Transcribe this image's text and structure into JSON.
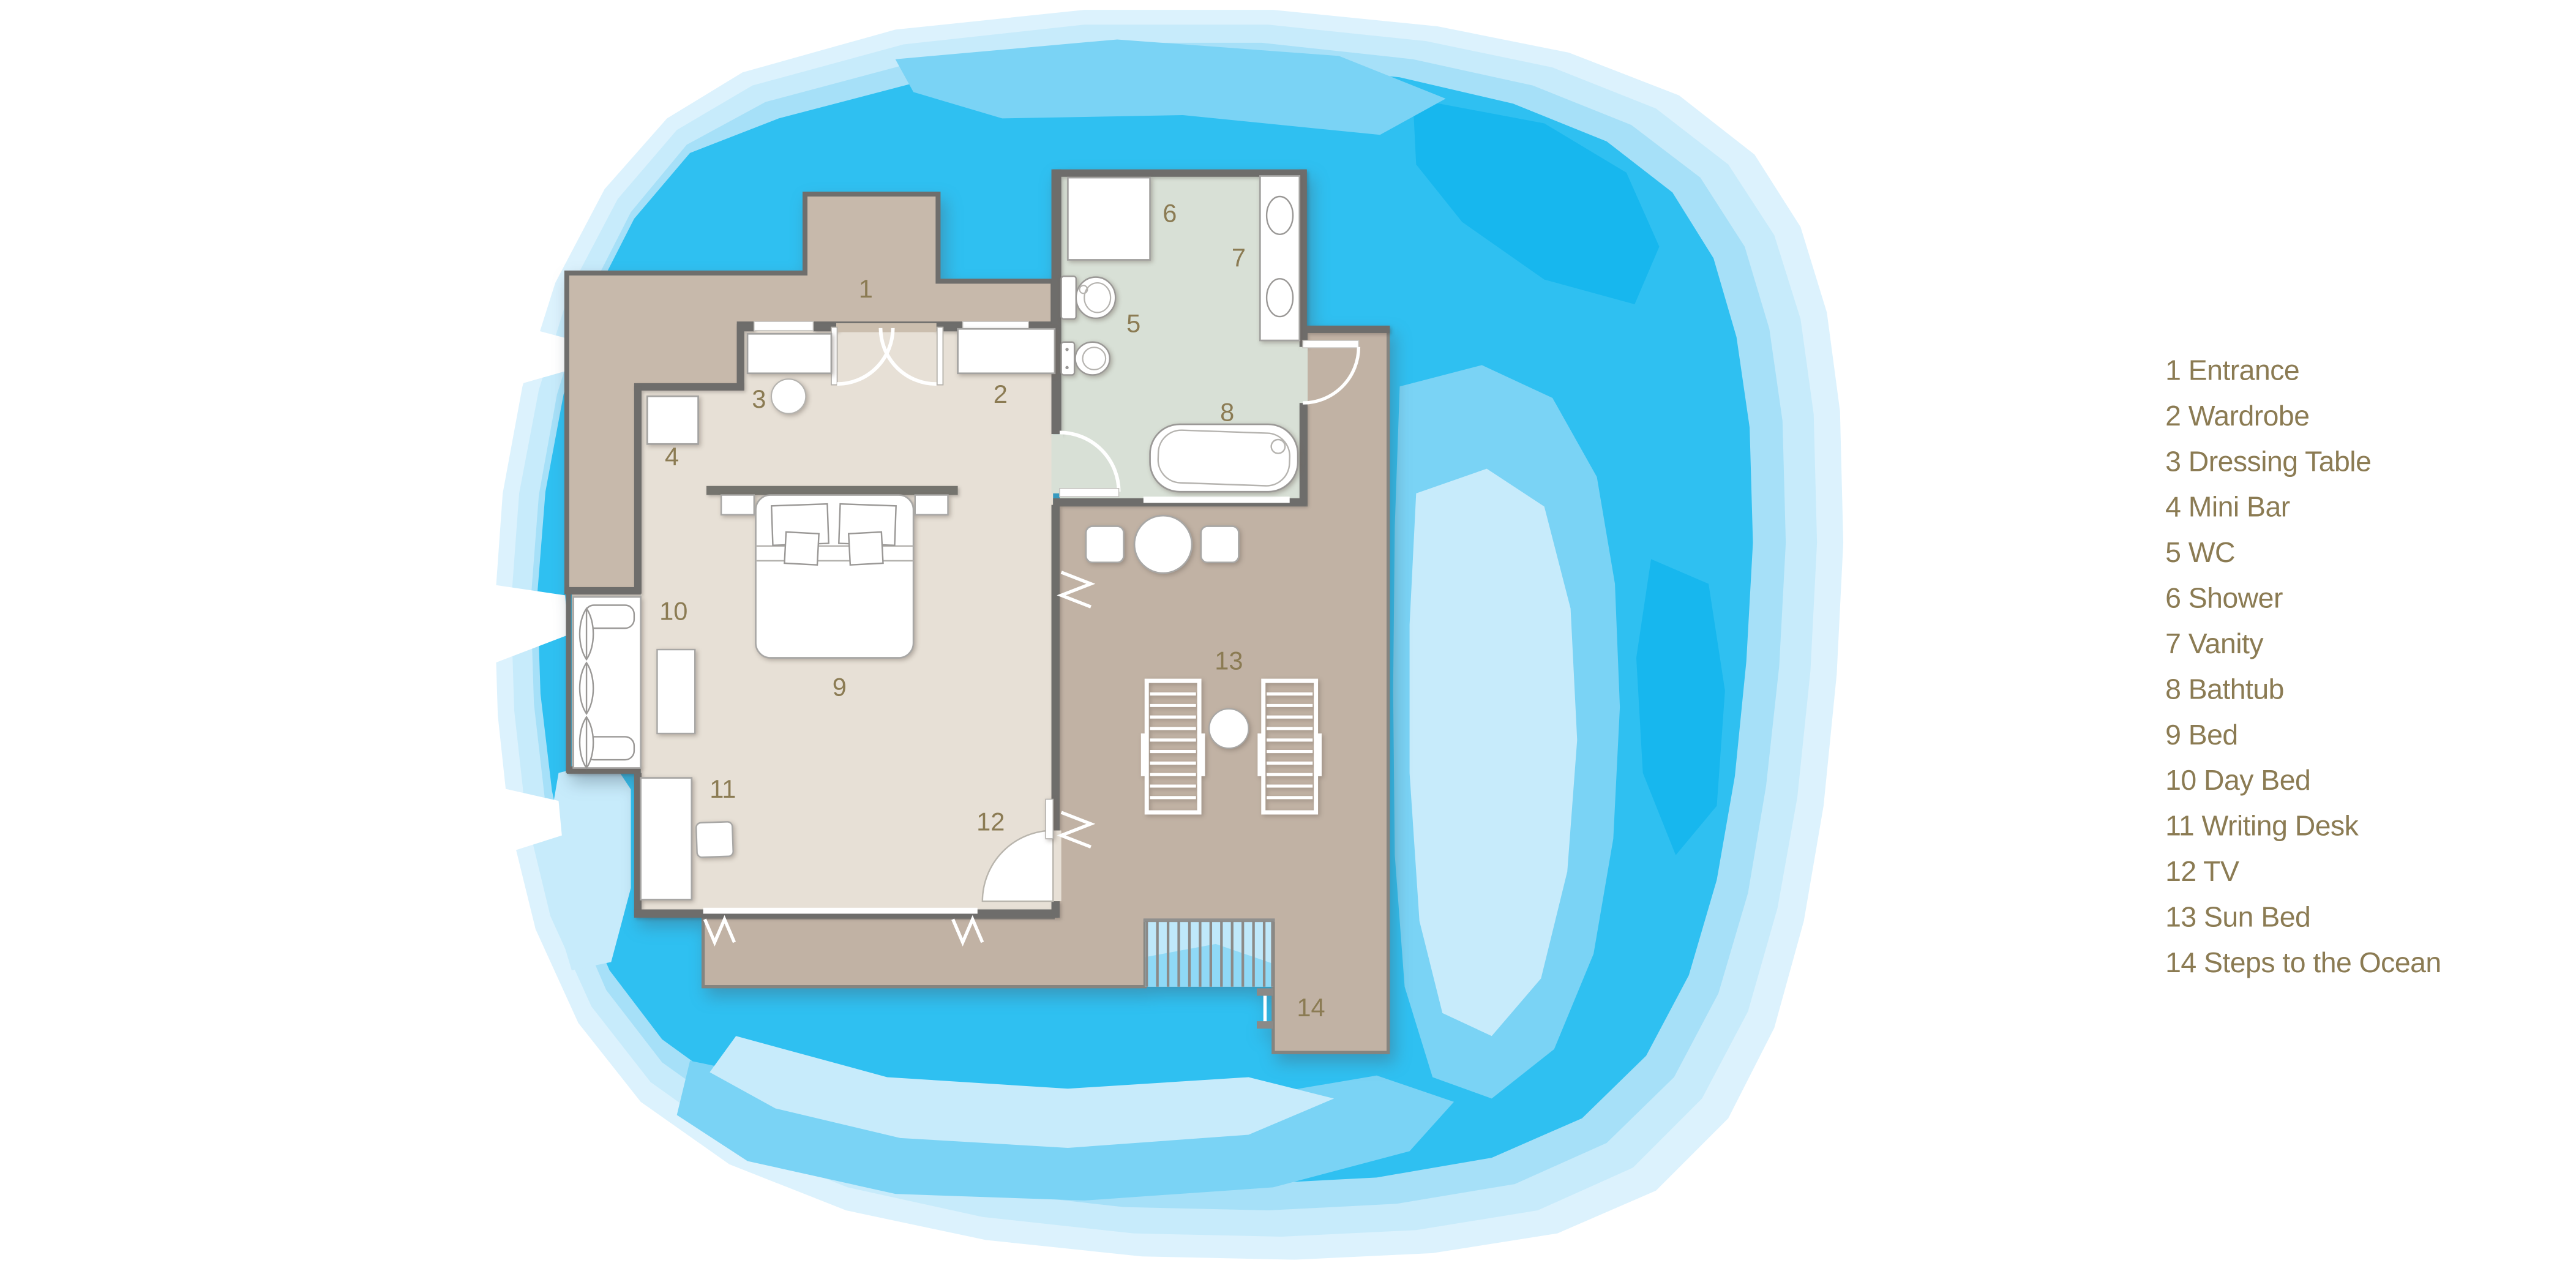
{
  "title": "Overwater Villa Floor Plan",
  "legend": {
    "items": [
      "1 Entrance",
      "2 Wardrobe",
      "3 Dressing Table",
      "4 Mini Bar",
      "5 WC",
      "6 Shower",
      "7 Vanity",
      "8 Bathtub",
      "9 Bed",
      "10 Day Bed",
      "11 Writing Desk",
      "12 TV",
      "13 Sun Bed",
      "14 Steps to the Ocean"
    ]
  },
  "plan": {
    "labels": [
      "1",
      "2",
      "3",
      "4",
      "5",
      "6",
      "7",
      "8",
      "9",
      "10",
      "11",
      "12",
      "13",
      "14"
    ]
  },
  "colors": {
    "water_bright": "#2fc0f1",
    "water_bright_dark": "#17b7ee",
    "water_mid": "#7ad3f5",
    "water_light": "#a6e0f8",
    "water_pale": "#c7ebfb",
    "water_palest": "#dcf2fd",
    "deck_tan": "#c1b2a4",
    "entrance_tan": "#c7b9ab",
    "bedroom_floor": "#e7e0d6",
    "bathroom_floor": "#d8e0d6",
    "wall_gray": "#6e6d6b",
    "label_brown": "#8b7b53"
  }
}
